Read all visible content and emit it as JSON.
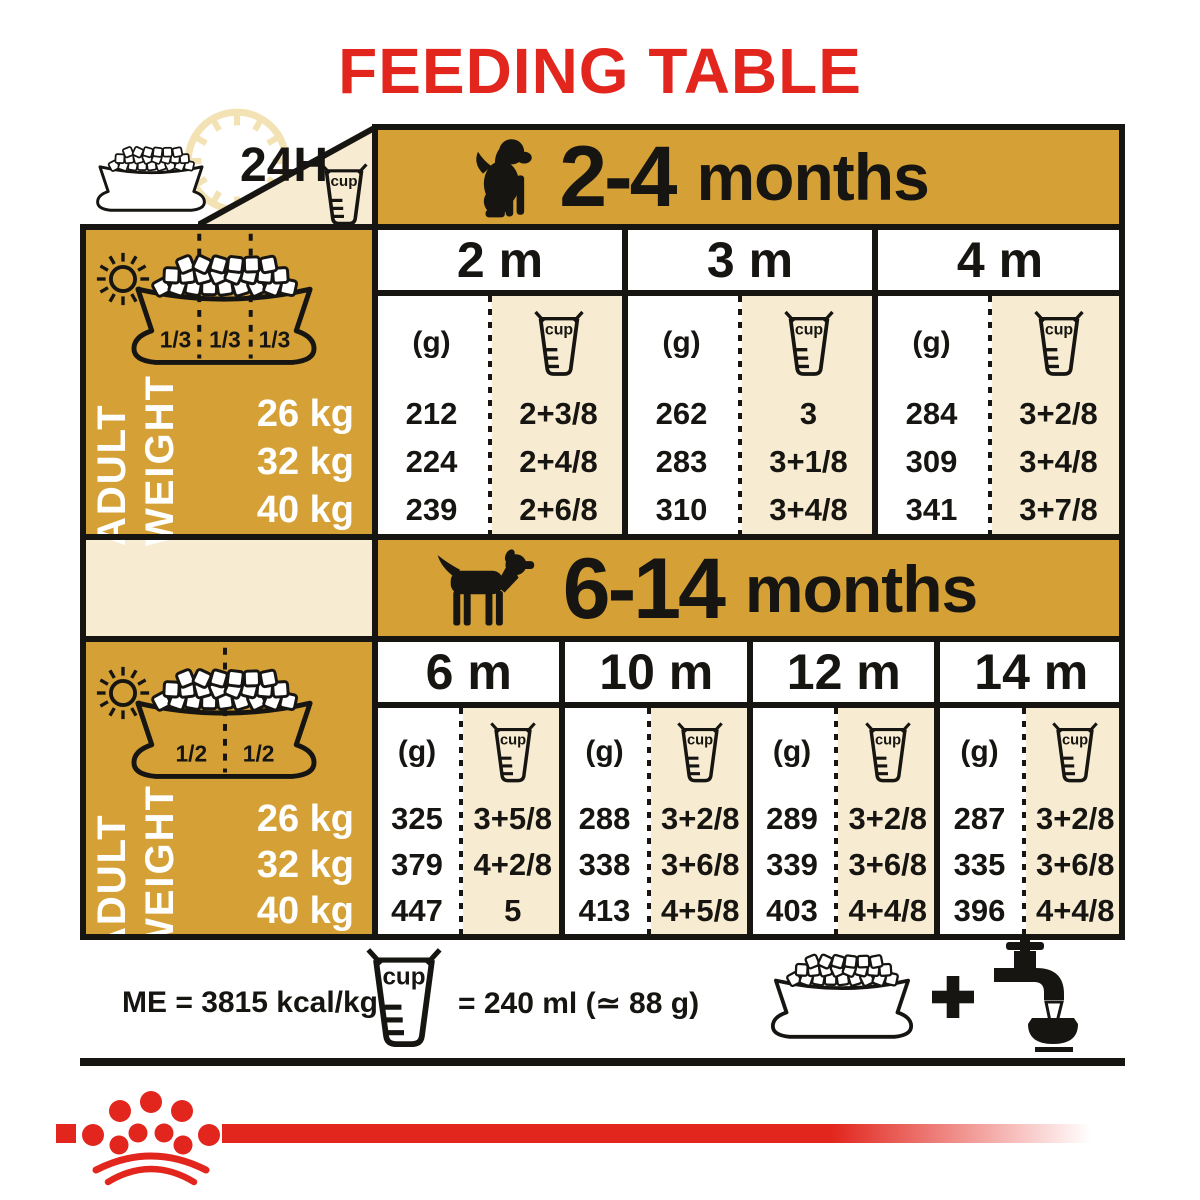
{
  "title": "FEEDING TABLE",
  "colors": {
    "gold": "#d5a136",
    "cream": "#f7ecd1",
    "ink": "#171512",
    "red": "#e2261e",
    "pale_clock": "#f3e2b4"
  },
  "legend": {
    "hours_label": "24H",
    "cup_label": "cup",
    "adult_weight": [
      "ADULT",
      "WEIGHT"
    ],
    "bowl_thirds": [
      "1/3",
      "1/3",
      "1/3"
    ],
    "bowl_halves": [
      "1/2",
      "1/2"
    ],
    "unit_grams_label": "(g)"
  },
  "sections": [
    {
      "age_range": "2-4",
      "age_suffix": "months",
      "dog_icon": "puppy-icon",
      "weights": [
        "26 kg",
        "32 kg",
        "40 kg"
      ],
      "months": [
        {
          "label": "2 m",
          "grams": [
            "212",
            "224",
            "239"
          ],
          "cups": [
            "2+3/8",
            "2+4/8",
            "2+6/8"
          ]
        },
        {
          "label": "3 m",
          "grams": [
            "262",
            "283",
            "310"
          ],
          "cups": [
            "3",
            "3+1/8",
            "3+4/8"
          ]
        },
        {
          "label": "4 m",
          "grams": [
            "284",
            "309",
            "341"
          ],
          "cups": [
            "3+2/8",
            "3+4/8",
            "3+7/8"
          ]
        }
      ]
    },
    {
      "age_range": "6-14",
      "age_suffix": "months",
      "dog_icon": "adult-dog-icon",
      "weights": [
        "26 kg",
        "32 kg",
        "40 kg"
      ],
      "months": [
        {
          "label": "6 m",
          "grams": [
            "325",
            "379",
            "447"
          ],
          "cups": [
            "3+5/8",
            "4+2/8",
            "5"
          ]
        },
        {
          "label": "10 m",
          "grams": [
            "288",
            "338",
            "413"
          ],
          "cups": [
            "3+2/8",
            "3+6/8",
            "4+5/8"
          ]
        },
        {
          "label": "12 m",
          "grams": [
            "289",
            "339",
            "403"
          ],
          "cups": [
            "3+2/8",
            "3+6/8",
            "4+4/8"
          ]
        },
        {
          "label": "14 m",
          "grams": [
            "287",
            "335",
            "396"
          ],
          "cups": [
            "3+2/8",
            "3+6/8",
            "4+4/8"
          ]
        }
      ]
    }
  ],
  "footer": {
    "me_label": "ME = 3815 kcal/kg",
    "cup_label": "cup",
    "cup_equiv": "= 240 ml (≃ 88 g)"
  }
}
